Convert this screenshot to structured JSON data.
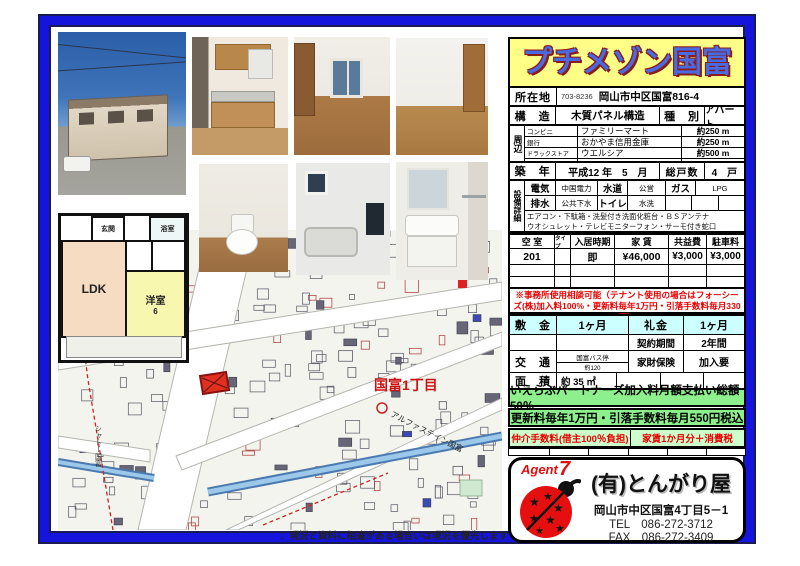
{
  "title": "プチメゾン国富",
  "location": {
    "label": "所在地",
    "postal": "703-8236",
    "address": "岡山市中区国富816-4"
  },
  "structure": {
    "label": "構　造",
    "value": "木質パネル構造",
    "type_label": "種　別",
    "type_value": "アパート"
  },
  "surroundings": {
    "label": "周辺",
    "rows": [
      {
        "category": "コンビニ",
        "name": "ファミリーマート",
        "distance": "約250 m"
      },
      {
        "category": "銀行",
        "name": "おかやま信用金庫",
        "distance": "約250 m"
      },
      {
        "category": "ドラックストア",
        "name": "ウエルシア",
        "distance": "約500 m"
      }
    ]
  },
  "built": {
    "label": "築　年",
    "value": "平成12 年　5　月",
    "units_label": "総戸数",
    "units": "4　戸"
  },
  "equipment": {
    "label": "設備詳細",
    "electric_label": "電気",
    "electric": "中国電力",
    "water_label": "水道",
    "water": "公営",
    "gas_label": "ガス",
    "gas": "LPG",
    "drain_label": "排水",
    "drain": "公共下水",
    "toilet_label": "トイレ",
    "toilet": "水洗",
    "note1": "エアコン・下駄箱・洗髪付き洗面化粧台・ＢＳアンテナ",
    "note2": "ウオシュレット・テレビモニターフォン・サーモ付き蛇口"
  },
  "vacancy": {
    "headers": [
      "空 室",
      "タイプ",
      "入居時期",
      "家 賃",
      "共益費",
      "駐車料"
    ],
    "row": {
      "room": "201",
      "type": "",
      "movein": "即",
      "rent": "¥46,000",
      "common": "¥3,000",
      "parking": "¥3,000"
    }
  },
  "office_note": "※事務所使用相談可能（テナント使用の場合はフォーシーズ(株)加入料100%・更新料毎年1万円・引落手数料毎月330円）",
  "terms": {
    "deposit_label": "敷　金",
    "deposit": "1ヶ月",
    "key_label": "礼金",
    "key": "1ヶ月",
    "contract_label": "契約期間",
    "contract": "2年間",
    "transport_label": "交　通",
    "transport_top": "国富バス停",
    "transport_bottom": "約120",
    "insurance_label": "家財保険",
    "insurance": "加入要",
    "area_label": "面　積",
    "area": "約 35 ㎡"
  },
  "green_notes": {
    "line1": "いえらぶパートナーズ加入料月額支払い総額50％",
    "line2": "更新料毎年1万円・引落手数料毎月550円税込"
  },
  "broker": {
    "left": "仲介手数料(借主100％負担)",
    "right": "家賃1か月分＋消費税"
  },
  "agency": {
    "agent_word": "Agent",
    "agent_num": "7",
    "name": "(有)とんがり屋",
    "address": "岡山市中区国富4丁目5－1",
    "tel": "TEL　086-272-3712",
    "fax": "FAX　086-272-3409"
  },
  "floorplan": {
    "entrance": "玄関",
    "bath": "浴室",
    "ldk": "LDK",
    "room": "洋室",
    "room_size": "6"
  },
  "map": {
    "district": "国富1丁目",
    "building": "アルファステイン国富",
    "building2": "シャトー国富"
  },
  "disclaimer": "：現況と資料に相違がある場合いは現況を優先します",
  "colors": {
    "frame": "#1414dd",
    "title_bg": "#ffff87",
    "title_text": "#4a6ae0",
    "cyan": "#ccffff",
    "green": "#8df08d",
    "red": "#e80000"
  }
}
